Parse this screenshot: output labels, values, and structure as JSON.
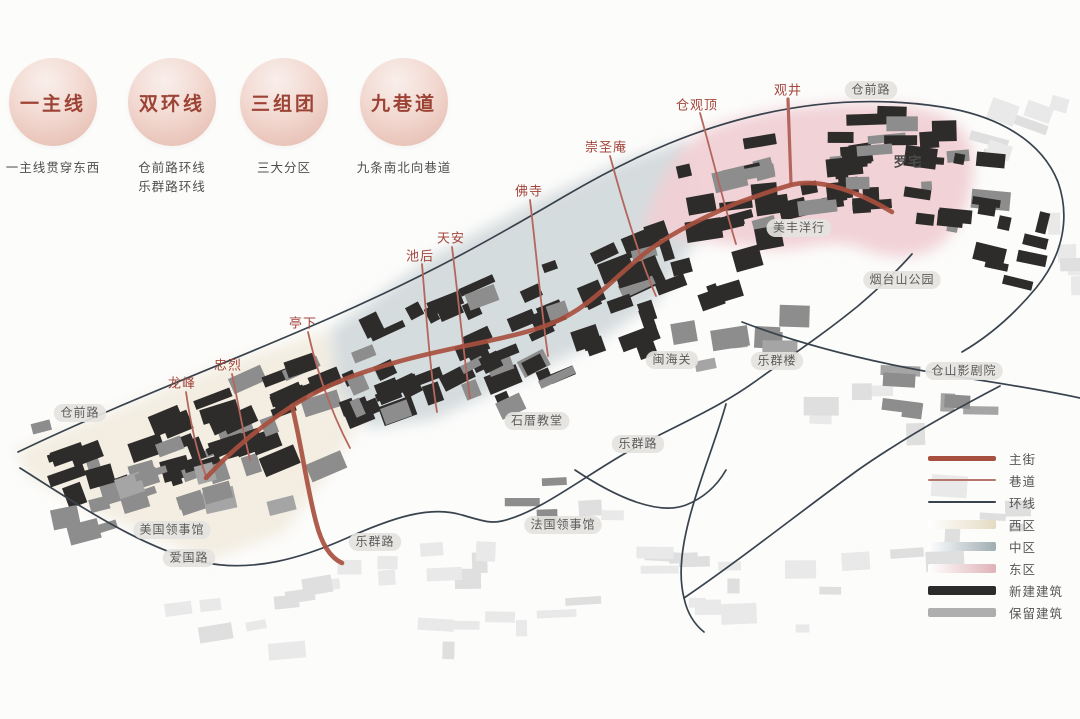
{
  "badges": [
    {
      "title": "一主线",
      "subtitles": [
        "一主线贯穿东西"
      ],
      "cx": 53
    },
    {
      "title": "双环线",
      "subtitles": [
        "仓前路环线",
        "乐群路环线"
      ],
      "cx": 172
    },
    {
      "title": "三组团",
      "subtitles": [
        "三大分区"
      ],
      "cx": 284
    },
    {
      "title": "九巷道",
      "subtitles": [
        "九条南北向巷道"
      ],
      "cx": 404
    }
  ],
  "map": {
    "lane_labels": [
      {
        "text": "龙峰",
        "x": 182,
        "y": 384
      },
      {
        "text": "忠烈",
        "x": 228,
        "y": 366
      },
      {
        "text": "亭下",
        "x": 303,
        "y": 324
      },
      {
        "text": "池后",
        "x": 420,
        "y": 257
      },
      {
        "text": "天安",
        "x": 451,
        "y": 239
      },
      {
        "text": "佛寺",
        "x": 529,
        "y": 192
      },
      {
        "text": "崇圣庵",
        "x": 606,
        "y": 148
      },
      {
        "text": "仓观顶",
        "x": 697,
        "y": 106
      },
      {
        "text": "观井",
        "x": 788,
        "y": 91
      }
    ],
    "pill_labels": [
      {
        "text": "仓前路",
        "x": 871,
        "y": 90
      },
      {
        "text": "仓前路",
        "x": 80,
        "y": 413
      },
      {
        "text": "美丰洋行",
        "x": 799,
        "y": 228
      },
      {
        "text": "烟台山公园",
        "x": 902,
        "y": 280
      },
      {
        "text": "乐群楼",
        "x": 777,
        "y": 361
      },
      {
        "text": "仓山影剧院",
        "x": 964,
        "y": 371
      },
      {
        "text": "闽海关",
        "x": 672,
        "y": 360
      },
      {
        "text": "石厝教堂",
        "x": 537,
        "y": 421
      },
      {
        "text": "乐群路",
        "x": 638,
        "y": 444
      },
      {
        "text": "乐群路",
        "x": 375,
        "y": 542
      },
      {
        "text": "法国领事馆",
        "x": 563,
        "y": 525
      },
      {
        "text": "美国领事馆",
        "x": 172,
        "y": 530
      },
      {
        "text": "爱国路",
        "x": 189,
        "y": 558
      }
    ],
    "plain_labels": [
      {
        "text": "罗宅",
        "x": 908,
        "y": 163
      }
    ]
  },
  "legend": {
    "items": [
      {
        "label": "主街",
        "type": "line",
        "color": "#a8503f",
        "weight": 5
      },
      {
        "label": "巷道",
        "type": "line",
        "color": "#b5776d",
        "weight": 2
      },
      {
        "label": "环线",
        "type": "line",
        "color": "#39434d",
        "weight": 2
      },
      {
        "label": "西区",
        "type": "fade",
        "color": "#e5dbc3"
      },
      {
        "label": "中区",
        "type": "fade",
        "color": "#9fadb3"
      },
      {
        "label": "东区",
        "type": "fade",
        "color": "#dfb2b7"
      },
      {
        "label": "新建建筑",
        "type": "solid",
        "color": "#2b2b2b"
      },
      {
        "label": "保留建筑",
        "type": "solid",
        "color": "#aeaeae"
      }
    ]
  },
  "colors": {
    "main_street": "#a8503f",
    "lane": "#b4665c",
    "ring": "#39434d",
    "west_zone": "#f1ebdd",
    "mid_zone": "#d2d8da",
    "east_zone": "#f0d0d5",
    "building_new": "#2e2c2a",
    "building_keep": "#8d8d8d",
    "building_bg": "#e9e9e9",
    "lane_label": "#a3463c",
    "pill_bg": "#e4e3e0",
    "pill_text": "#5c5c5c",
    "plain_label": "#4b4b4b"
  }
}
